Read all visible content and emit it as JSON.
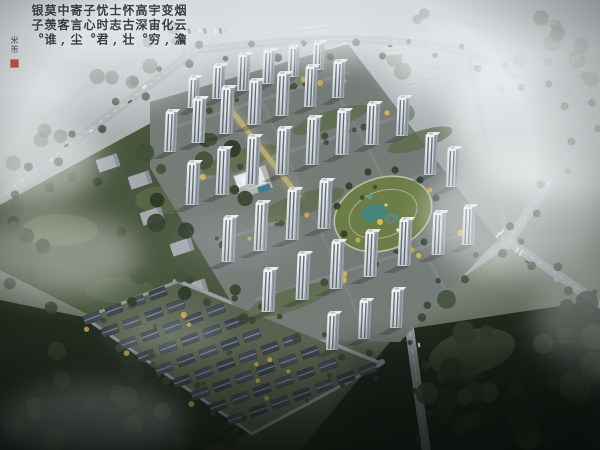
{
  "scene": {
    "description": "Hazy aerial rendering of a residential compound: white high-rise towers around a landscaped oval park with pond, an autumn townhouse grid, perimeter roads with traffic, dense forest and drifting fog"
  },
  "calligraphy": {
    "columns": [
      "烟云澹",
      "变化,",
      "宇宙穷",
      "高深。",
      "怀古壮",
      "士志,",
      "忧时君",
      "子心。",
      "寄言尘",
      "中客,",
      "莫羡谁",
      "银子。"
    ],
    "signature": "米芾"
  },
  "palette": {
    "haze": "#eef1f3",
    "road": "#a4aaad",
    "facade": "#dfe3e7",
    "forest_dark": "#2c3829",
    "lawn": "#6c7e47",
    "pond": "#49857d",
    "autumn_tree": "#c9a94f",
    "seal_red": "#a33b2b"
  }
}
